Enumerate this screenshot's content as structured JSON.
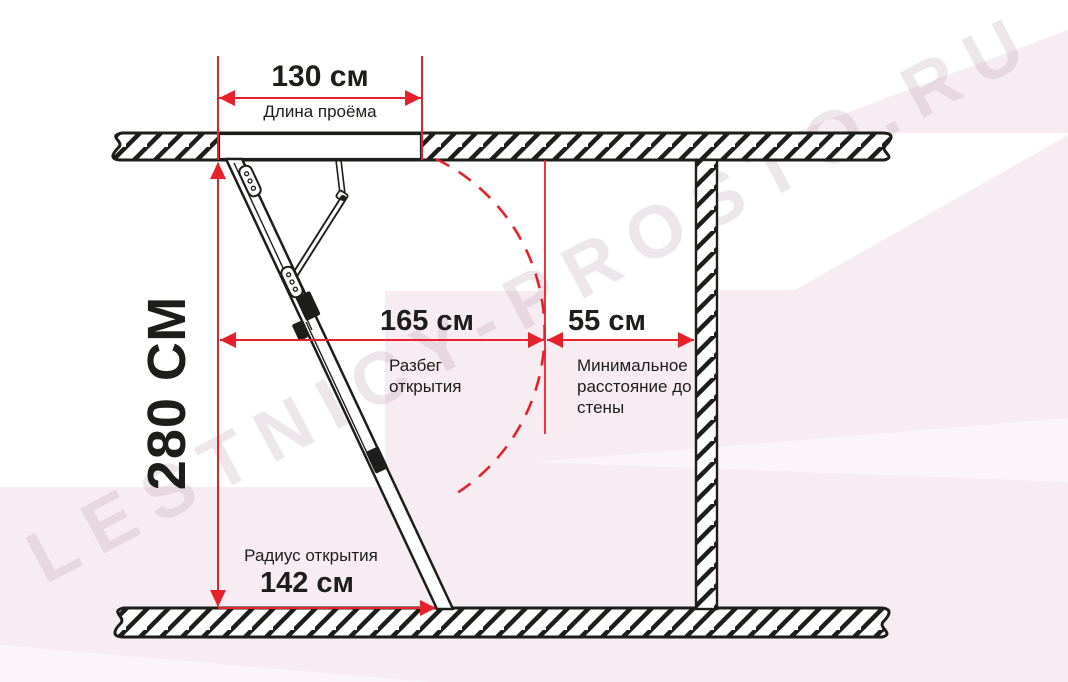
{
  "watermark": {
    "text": "LESTNICY-PROSTO.RU"
  },
  "dimensions": {
    "opening_length": {
      "value": "130 см",
      "label": "Длина проёма"
    },
    "ceiling_height": {
      "value": "280 СМ"
    },
    "opening_span": {
      "value": "165 см",
      "label": "Разбег открытия"
    },
    "wall_distance": {
      "value": "55 см",
      "label": "Минимальное расстояние до стены"
    },
    "opening_radius": {
      "value": "142 см",
      "label": "Радиус открытия"
    }
  },
  "colors": {
    "accent-red": "#e6212b",
    "ink": "#1d1d1b",
    "bg-pink": "#f7ecf2",
    "bg-pink-light": "#fbf4f8",
    "watermark": "#a9879b"
  }
}
